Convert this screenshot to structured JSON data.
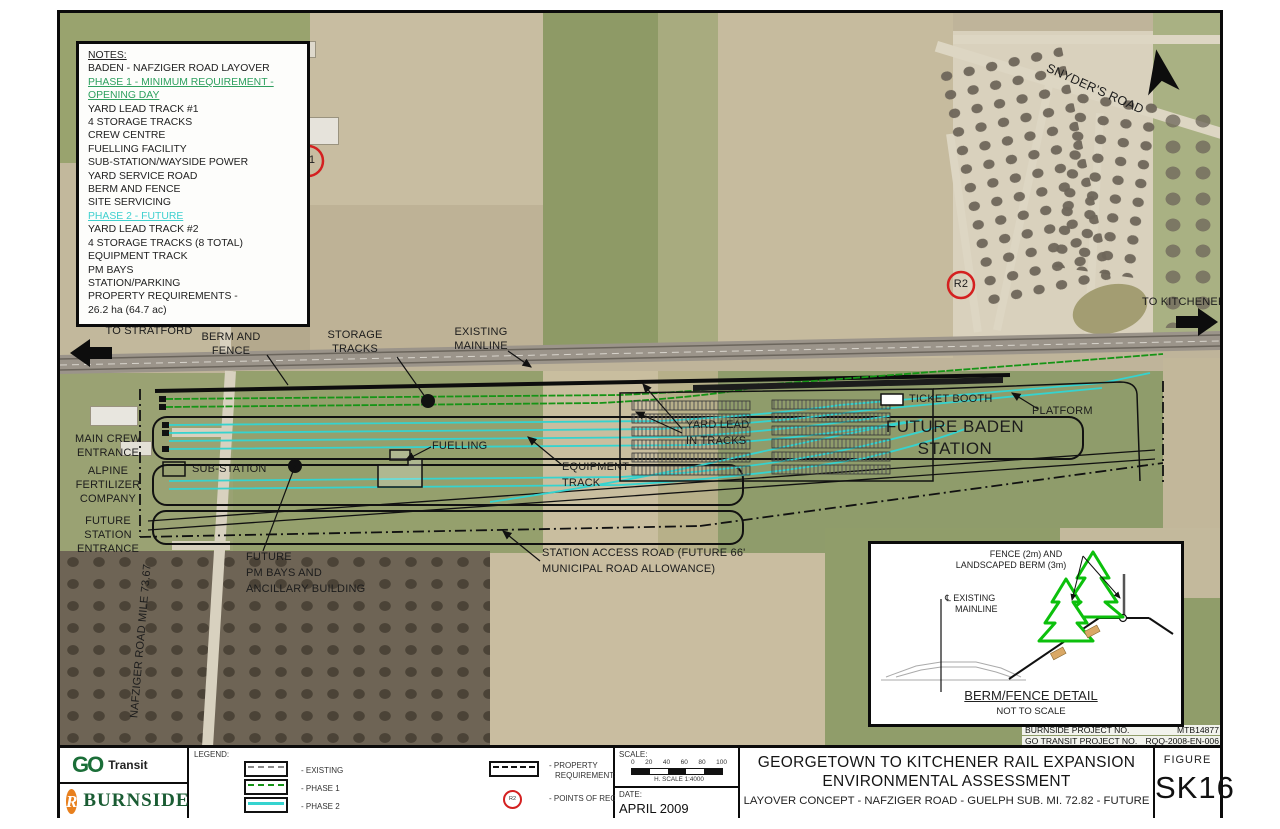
{
  "notes": {
    "heading": "NOTES:",
    "subject": "BADEN - NAFZIGER ROAD LAYOVER",
    "phase1_heading": "PHASE 1 - MINIMUM REQUIREMENT - OPENING DAY",
    "phase1_items": [
      "YARD LEAD TRACK #1",
      "4 STORAGE TRACKS",
      "CREW CENTRE",
      "FUELLING FACILITY",
      "SUB-STATION/WAYSIDE POWER",
      "YARD SERVICE ROAD",
      "BERM AND FENCE",
      "SITE SERVICING"
    ],
    "phase2_heading": "PHASE 2 - FUTURE",
    "phase2_items": [
      "YARD LEAD TRACK #2",
      "4 STORAGE TRACKS (8 TOTAL)",
      "EQUIPMENT TRACK",
      "PM BAYS",
      "STATION/PARKING",
      "PROPERTY REQUIREMENTS -",
      "26.2 ha (64.7 ac)"
    ]
  },
  "map": {
    "to_stratford": "TO STRATFORD",
    "berm_fence_l1": "BERM AND",
    "berm_fence_l2": "FENCE",
    "storage_l1": "STORAGE",
    "storage_l2": "TRACKS",
    "mainline_l1": "EXISTING",
    "mainline_l2": "MAINLINE",
    "snyders_road": "SNYDER'S ROAD",
    "to_kitchener": "TO KITCHENER",
    "r1": "R1",
    "r2": "R2",
    "main_crew_l1": "MAIN CREW",
    "main_crew_l2": "ENTRANCE",
    "alpine_l1": "ALPINE",
    "alpine_l2": "FERTILIZER",
    "alpine_l3": "COMPANY",
    "future_entrance_l1": "FUTURE",
    "future_entrance_l2": "STATION",
    "future_entrance_l3": "ENTRANCE",
    "nafziger_road": "NAFZIGER ROAD MILE 73.67",
    "sub_station": "SUB-STATION",
    "fuelling": "FUELLING",
    "equipment_l1": "EQUIPMENT",
    "equipment_l2": "TRACK",
    "yard_lead_l1": "YARD LEAD",
    "yard_lead_l2": "IN TRACKS",
    "ticket_booth": "TICKET BOOTH",
    "platform": "PLATFORM",
    "station_l1": "FUTURE BADEN",
    "station_l2": "STATION",
    "pm_bays_l1": "FUTURE",
    "pm_bays_l2": "PM BAYS AND",
    "pm_bays_l3": "ANCILLARY BUILDING",
    "access_road_l1": "STATION ACCESS ROAD (FUTURE 66'",
    "access_road_l2": "MUNICIPAL ROAD ALLOWANCE)"
  },
  "inset": {
    "fence_label_l1": "FENCE (2m) AND",
    "fence_label_l2": "LANDSCAPED BERM (3m)",
    "cl_label_l1": "℄ EXISTING",
    "cl_label_l2": "MAINLINE",
    "title": "BERM/FENCE DETAIL",
    "subtitle": "NOT TO SCALE"
  },
  "project_nos": {
    "burnside_label": "BURNSIDE PROJECT NO.",
    "burnside_value": "MTB14877",
    "go_label": "GO TRANSIT PROJECT NO.",
    "go_value": "RQQ-2008-EN-006"
  },
  "titleblock": {
    "go_logo": {
      "go": "GO",
      "transit": "Transit"
    },
    "burnside_logo": {
      "mark": "R",
      "name": "BURNSIDE"
    },
    "legend": {
      "heading": "LEGEND:",
      "existing": "- EXISTING",
      "phase1": "- PHASE 1",
      "phase2": "- PHASE 2",
      "property_l1": "- PROPERTY",
      "property_l2": "REQUIREMENTS",
      "points": "- POINTS OF RECEPTION",
      "point_icon": "R2"
    },
    "scale": {
      "label": "SCALE:",
      "ticks": [
        "0",
        "20",
        "40",
        "60",
        "80",
        "100"
      ],
      "caption": "H. SCALE 1:4000"
    },
    "date": {
      "label": "DATE:",
      "value": "APRIL 2009"
    },
    "title_line1": "GEORGETOWN TO KITCHENER RAIL EXPANSION",
    "title_line2": "ENVIRONMENTAL ASSESSMENT",
    "subtitle": "LAYOVER CONCEPT - NAFZIGER ROAD - GUELPH SUB. MI. 72.82 - FUTURE",
    "figure_label": "FIGURE",
    "figure_number": "SK16"
  },
  "colors": {
    "phase1_track": "#169416",
    "phase2_track": "#35d3cf",
    "notes_phase1": "#2ea05f",
    "notes_phase2": "#3fd0cf",
    "reception_marker": "#d42020"
  }
}
